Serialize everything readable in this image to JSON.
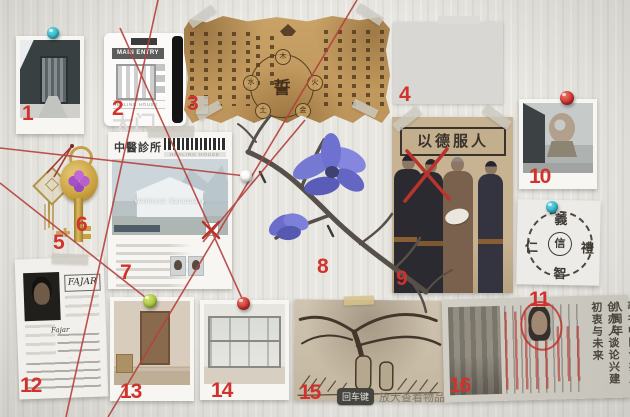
{
  "numbers": {
    "n1": "1",
    "n2": "2",
    "n3": "3",
    "n4": "4",
    "n5": "5",
    "n6": "6",
    "n7": "7",
    "n8": "8",
    "n9": "9",
    "n10": "10",
    "n11": "11",
    "n12": "12",
    "n13": "13",
    "n14": "14",
    "n15": "15",
    "n16": "16"
  },
  "access_card": {
    "main_entry": "MAIN ENTRY",
    "healing_house": "HEALING HOUSE",
    "gate_label": "大门"
  },
  "oath_scroll": {
    "center_char": "誓",
    "elements": [
      "木",
      "水",
      "火",
      "土",
      "金"
    ]
  },
  "clinic_flyer": {
    "title": "中醫診所",
    "subtitle": "HEALING HOUSE",
    "photo_caption": "Wellness Sanctuary"
  },
  "family_poster": {
    "banner": "以德服人"
  },
  "seal_paper": {
    "top": "義",
    "left": "仁",
    "right": "禮",
    "bottom": "智",
    "center": "信"
  },
  "personnel_file": {
    "name_header": "FAJAR",
    "name_value": "Fajar"
  },
  "newspaper": {
    "headline_right": "著名中医诊疗所八周年",
    "headline_left": "创办人谈论兴建初衷与未来"
  },
  "hint": {
    "key_label": "回车键",
    "action_label": "放大查看物品"
  },
  "colors": {
    "string_red": "#b5413c",
    "number_red": "#d2322c",
    "pin_cyan": "#2fb6c8",
    "pin_red": "#c9302a",
    "pin_green": "#a9c43a",
    "pin_white": "#f2f2ef"
  }
}
